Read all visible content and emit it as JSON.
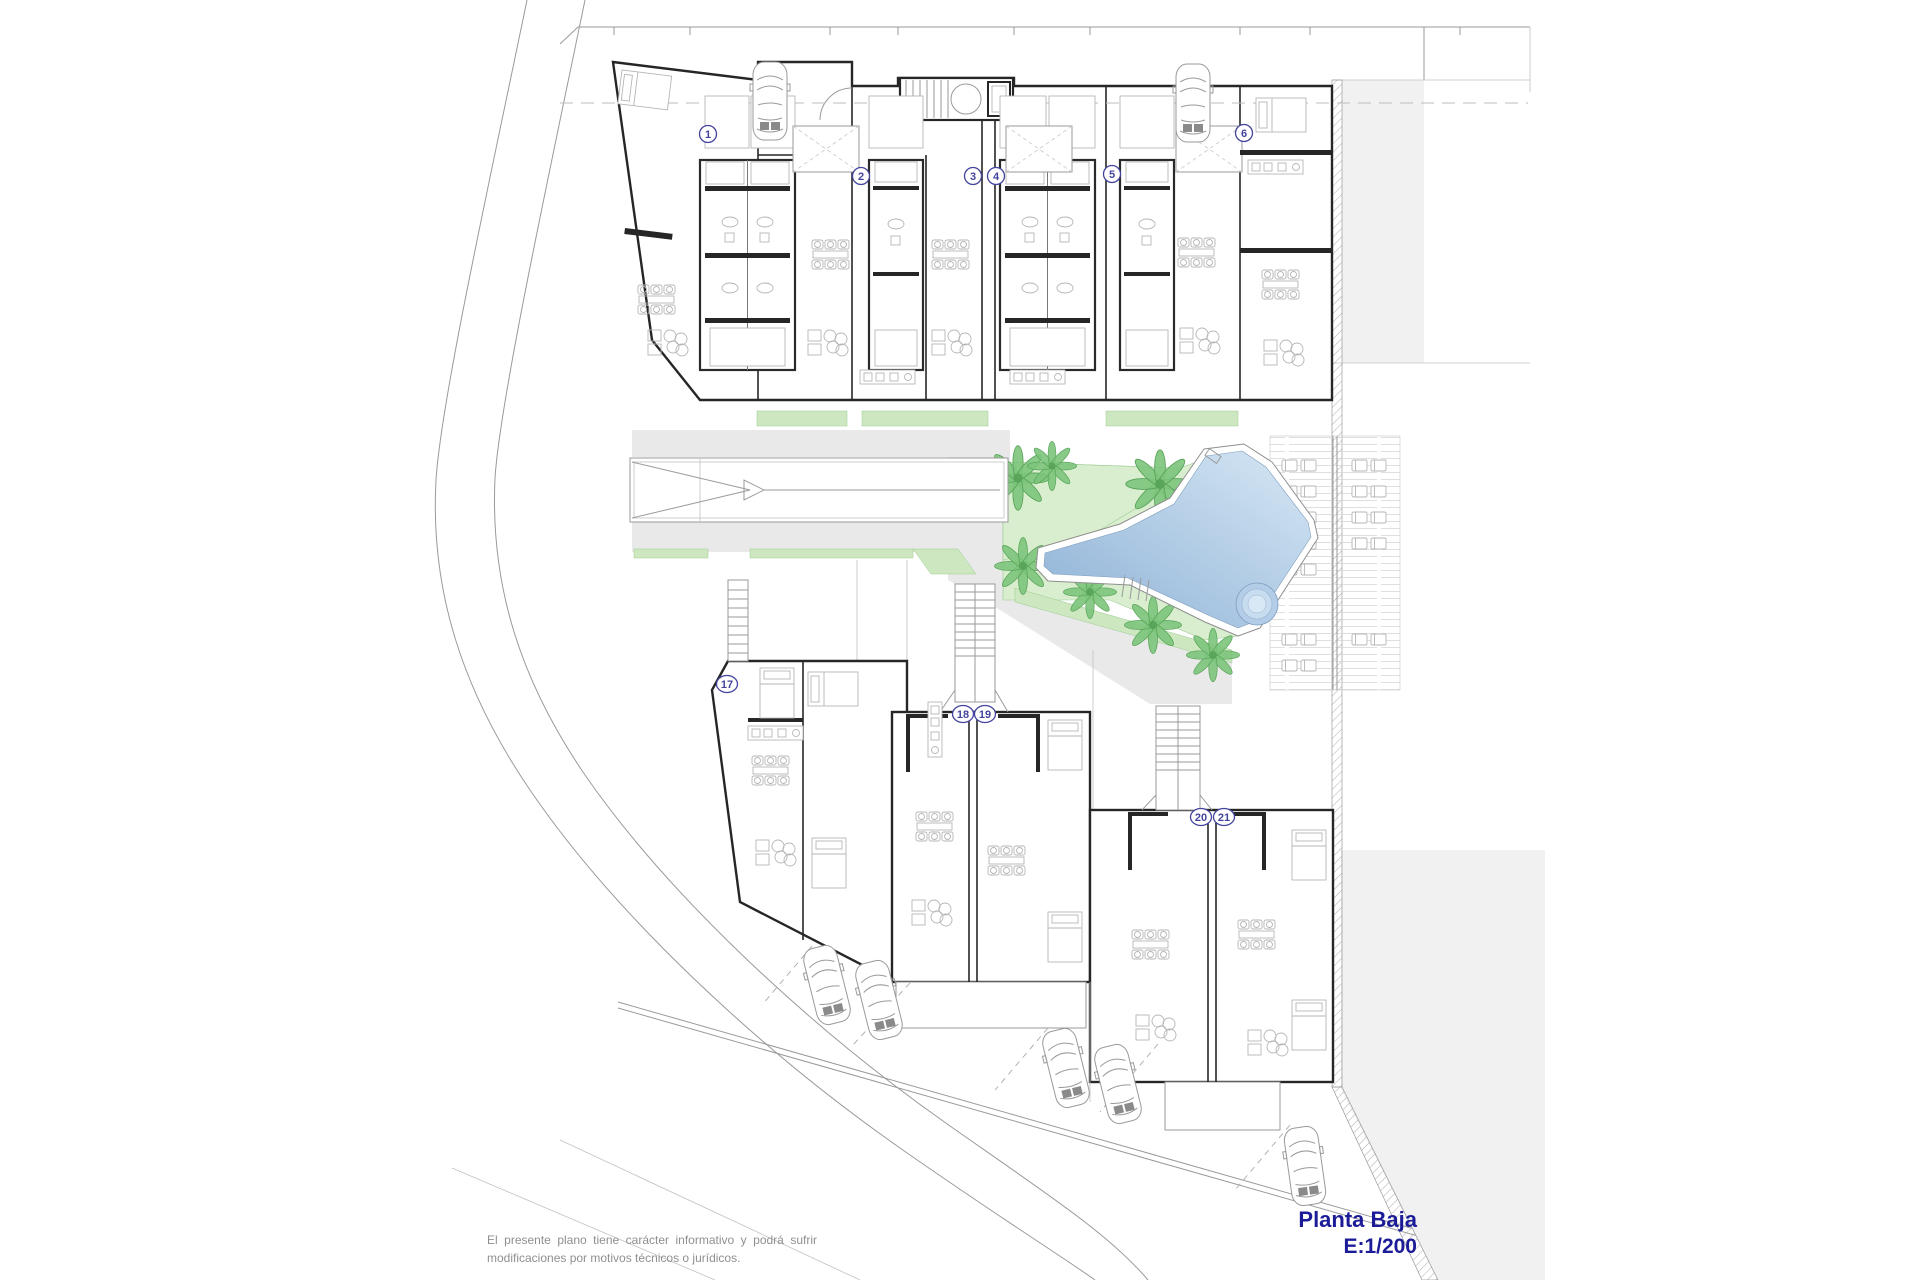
{
  "title_block": {
    "title": "Planta Baja",
    "scale": "E:1/200"
  },
  "disclaimer": {
    "line1": "El presente plano tiene carácter informativo y podrá sufrir",
    "line2": "modificaciones por motivos técnicos o jurídicos."
  },
  "unit_labels": [
    {
      "number": "1",
      "x": 708,
      "y": 134
    },
    {
      "number": "2",
      "x": 861,
      "y": 176
    },
    {
      "number": "3",
      "x": 973,
      "y": 176
    },
    {
      "number": "4",
      "x": 996,
      "y": 176
    },
    {
      "number": "5",
      "x": 1112,
      "y": 174
    },
    {
      "number": "6",
      "x": 1244,
      "y": 133
    },
    {
      "number": "17",
      "x": 727,
      "y": 684
    },
    {
      "number": "18",
      "x": 963,
      "y": 714
    },
    {
      "number": "19",
      "x": 985,
      "y": 714
    },
    {
      "number": "20",
      "x": 1201,
      "y": 817
    },
    {
      "number": "21",
      "x": 1224,
      "y": 817
    }
  ],
  "colors": {
    "title_blue": "#1c1c99",
    "label_blue": "#44449e",
    "lawn_green": "#d9eecf",
    "strip_green": "#cde8c0",
    "palm_green": "#7cc47c",
    "pool_dark": "#8db1d6",
    "pool_light": "#d6e7f4",
    "path_gray": "#e9e9e9",
    "street_gray": "#f1f1f1",
    "disclaimer_gray": "#8f8f8f"
  }
}
